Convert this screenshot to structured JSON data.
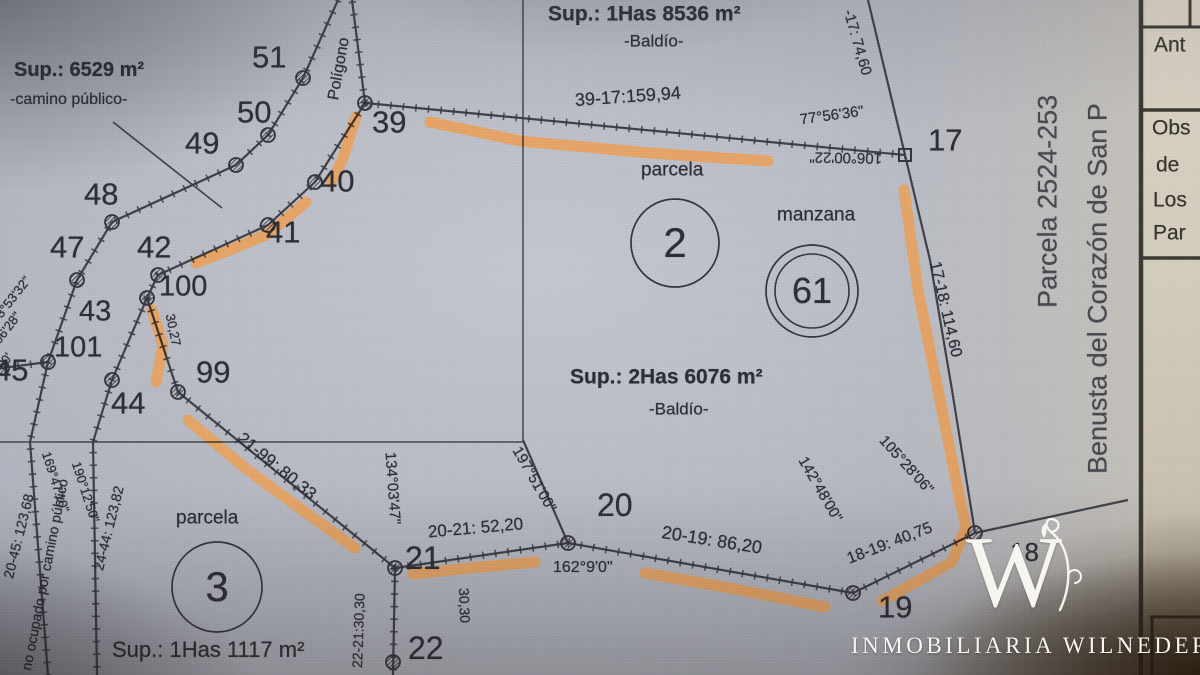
{
  "colors": {
    "highlight": "#f0a45c",
    "ink": "#32323c",
    "sheet_line": "#3a3a44",
    "panel_ink": "#2b2925",
    "panel_bg": "#d8d1c1",
    "brand_white": "#f7f5f0"
  },
  "panel": {
    "ant": "Ant",
    "obs": "Obs",
    "de": "de",
    "los": "Los",
    "par": "Par"
  },
  "watermark": {
    "monogram": "W",
    "brand": "INMOBILIARIA WILNEDER"
  },
  "map": {
    "labels": [
      {
        "t": "Sup.: 6529 m²",
        "x": 14,
        "y": 70,
        "s": 20,
        "b": 1,
        "n": "area-label-camino"
      },
      {
        "t": "-camino público-",
        "x": 10,
        "y": 100,
        "s": 16,
        "n": "area-sublabel-camino"
      },
      {
        "t": "51",
        "x": 252,
        "y": 57,
        "s": 31,
        "n": "vertex-label-51"
      },
      {
        "t": "50",
        "x": 237,
        "y": 112,
        "s": 31,
        "n": "vertex-label-50"
      },
      {
        "t": "49",
        "x": 185,
        "y": 143,
        "s": 31,
        "n": "vertex-label-49"
      },
      {
        "t": "48",
        "x": 84,
        "y": 194,
        "s": 31,
        "n": "vertex-label-48"
      },
      {
        "t": "47",
        "x": 50,
        "y": 247,
        "s": 31,
        "n": "vertex-label-47"
      },
      {
        "t": "42",
        "x": 137,
        "y": 247,
        "s": 31,
        "n": "vertex-label-42"
      },
      {
        "t": "100",
        "x": 159,
        "y": 287,
        "s": 29,
        "n": "vertex-label-100"
      },
      {
        "t": "43",
        "x": 79,
        "y": 312,
        "s": 29,
        "n": "vertex-label-43"
      },
      {
        "t": "101",
        "x": 54,
        "y": 348,
        "s": 29,
        "n": "vertex-label-101"
      },
      {
        "t": "45",
        "x": -6,
        "y": 370,
        "s": 31,
        "n": "vertex-label-45"
      },
      {
        "t": "44",
        "x": 111,
        "y": 403,
        "s": 31,
        "n": "vertex-label-44"
      },
      {
        "t": "99",
        "x": 196,
        "y": 372,
        "s": 31,
        "n": "vertex-label-99"
      },
      {
        "t": "39",
        "x": 372,
        "y": 122,
        "s": 31,
        "n": "vertex-label-39"
      },
      {
        "t": "40",
        "x": 320,
        "y": 181,
        "s": 31,
        "n": "vertex-label-40"
      },
      {
        "t": "41",
        "x": 266,
        "y": 232,
        "s": 31,
        "n": "vertex-label-41"
      },
      {
        "t": "Sup.: 1Has 8536 m²",
        "x": 548,
        "y": 14,
        "s": 21,
        "b": 1,
        "n": "area-label-top-parcel"
      },
      {
        "t": "-Baldío-",
        "x": 624,
        "y": 41,
        "s": 17
      },
      {
        "t": "39-17:159,94",
        "x": 575,
        "y": 100,
        "s": 18,
        "r": -4,
        "n": "distance-39-17"
      },
      {
        "t": "77°56'36\"",
        "x": 800,
        "y": 120,
        "s": 15,
        "r": -8
      },
      {
        "t": "106°00'22\"",
        "x": 882,
        "y": 158,
        "s": 15,
        "r": 181
      },
      {
        "t": "17",
        "x": 928,
        "y": 140,
        "s": 31,
        "n": "vertex-label-17"
      },
      {
        "t": "parcela",
        "x": 641,
        "y": 170,
        "s": 19,
        "n": "parcela-2-caption"
      },
      {
        "t": "manzana",
        "x": 777,
        "y": 215,
        "s": 19,
        "n": "manzana-caption"
      },
      {
        "t": "Sup.: 2Has 6076 m²",
        "x": 570,
        "y": 377,
        "s": 21,
        "b": 1,
        "n": "area-label-parcel2"
      },
      {
        "t": "-Baldío-",
        "x": 649,
        "y": 409,
        "s": 17
      },
      {
        "t": "20",
        "x": 597,
        "y": 505,
        "s": 32,
        "n": "vertex-label-20"
      },
      {
        "t": "162°9'0\"",
        "x": 553,
        "y": 568,
        "s": 16
      },
      {
        "t": "20-19: 86,20",
        "x": 662,
        "y": 532,
        "s": 18,
        "r": 9,
        "n": "distance-20-19"
      },
      {
        "t": "19",
        "x": 878,
        "y": 607,
        "s": 31,
        "n": "vertex-label-19"
      },
      {
        "t": "21",
        "x": 405,
        "y": 558,
        "s": 32,
        "n": "vertex-label-21"
      },
      {
        "t": "20-21: 52,20",
        "x": 428,
        "y": 532,
        "s": 17,
        "r": -5,
        "n": "distance-20-21"
      },
      {
        "t": "22",
        "x": 408,
        "y": 648,
        "s": 32,
        "n": "vertex-label-22"
      },
      {
        "t": "parcela",
        "x": 176,
        "y": 518,
        "s": 19,
        "n": "parcela-3-caption"
      },
      {
        "t": "Sup.: 1Has 1117 m²",
        "x": 112,
        "y": 650,
        "s": 22,
        "n": "area-label-parcel3"
      },
      {
        "t": "Polígono",
        "x": 334,
        "y": 100,
        "s": 16,
        "r": -80
      },
      {
        "t": "-17: 74,60",
        "x": 848,
        "y": 10,
        "s": 15,
        "r": 74
      },
      {
        "t": "17-18: 114,60",
        "x": 934,
        "y": 262,
        "s": 16,
        "r": 77,
        "n": "distance-17-18"
      },
      {
        "t": "105°28'06\"",
        "x": 882,
        "y": 438,
        "s": 15,
        "r": 48
      },
      {
        "t": "142°48'00\"",
        "x": 802,
        "y": 458,
        "s": 15,
        "r": 60
      },
      {
        "t": "18-19: 40,75",
        "x": 848,
        "y": 560,
        "s": 16,
        "r": -21,
        "n": "distance-18-19"
      },
      {
        "t": "197°51'00\"",
        "x": 516,
        "y": 448,
        "s": 15,
        "r": 60
      },
      {
        "t": "21-99: 80,33",
        "x": 240,
        "y": 436,
        "s": 17,
        "r": 39,
        "n": "distance-21-99"
      },
      {
        "t": "134°03'47\"",
        "x": 390,
        "y": 452,
        "s": 15,
        "r": 86
      },
      {
        "t": "22-21:30,30",
        "x": 357,
        "y": 668,
        "s": 14,
        "r": -88,
        "n": "distance-22-21"
      },
      {
        "t": "30,30",
        "x": 464,
        "y": 588,
        "s": 14,
        "r": 88
      },
      {
        "t": "30,27",
        "x": 170,
        "y": 314,
        "s": 13,
        "r": 78
      },
      {
        "t": "20-45: 123,68",
        "x": 8,
        "y": 578,
        "s": 14,
        "r": -76
      },
      {
        "t": "24-44: 123,82",
        "x": 98,
        "y": 570,
        "s": 14,
        "r": -76
      },
      {
        "t": "169°47'10\"",
        "x": 46,
        "y": 452,
        "s": 13,
        "r": 72
      },
      {
        "t": "190°12'50\"",
        "x": 76,
        "y": 462,
        "s": 13,
        "r": 72
      },
      {
        "t": "no ocupado por camino público",
        "x": 26,
        "y": 670,
        "s": 14,
        "r": -79,
        "n": "road-caption"
      },
      {
        "t": "3°53'32\"",
        "x": -2,
        "y": 316,
        "s": 13,
        "r": -52
      },
      {
        "t": "06'28\"",
        "x": -4,
        "y": 342,
        "s": 13,
        "r": -52
      },
      {
        "t": "°50'",
        "x": -4,
        "y": 372,
        "s": 13,
        "r": -52
      },
      {
        "t": "18",
        "x": 1010,
        "y": 552,
        "s": 26,
        "n": "vertex-label-18"
      },
      {
        "t": "Parcela 2524-253",
        "x": 1048,
        "y": 308,
        "s": 27,
        "r": -90,
        "c": "soft",
        "n": "side-text-parcela"
      },
      {
        "t": "Benusta del Corazón de San P",
        "x": 1098,
        "y": 474,
        "s": 27,
        "r": -90,
        "c": "soft",
        "n": "side-text-benusta"
      }
    ],
    "circles": [
      {
        "x": 675,
        "y": 243,
        "r": 44,
        "num": "2",
        "fs": 42,
        "n": "parcela-2-circle"
      },
      {
        "x": 812,
        "y": 291,
        "r": 46,
        "r2": 37,
        "num": "61",
        "fs": 36,
        "n": "manzana-61-circle"
      },
      {
        "x": 217,
        "y": 587,
        "r": 45,
        "num": "3",
        "fs": 42,
        "n": "parcela-3-circle"
      }
    ],
    "lines": [
      {
        "p": [
          [
            365,
            103
          ],
          [
            905,
            155
          ]
        ],
        "cls": "tick"
      },
      {
        "p": [
          [
            365,
            103
          ],
          [
            352,
            0
          ]
        ],
        "cls": "tick"
      },
      {
        "p": [
          [
            365,
            103
          ],
          [
            315,
            182
          ],
          [
            268,
            225
          ],
          [
            158,
            275
          ],
          [
            147,
            298
          ]
        ],
        "cls": "tick"
      },
      {
        "p": [
          [
            338,
            0
          ],
          [
            303,
            78
          ],
          [
            268,
            135
          ],
          [
            236,
            165
          ],
          [
            112,
            222
          ],
          [
            77,
            280
          ],
          [
            48,
            362
          ],
          [
            2,
            368
          ]
        ],
        "cls": "tick"
      },
      {
        "p": [
          [
            48,
            362
          ],
          [
            30,
            442
          ],
          [
            48,
            675
          ]
        ],
        "cls": "tick"
      },
      {
        "p": [
          [
            147,
            298
          ],
          [
            112,
            380
          ],
          [
            93,
            442
          ],
          [
            97,
            675
          ]
        ],
        "cls": "tick"
      },
      {
        "p": [
          [
            147,
            298
          ],
          [
            178,
            392
          ]
        ],
        "cls": "tick"
      },
      {
        "p": [
          [
            178,
            392
          ],
          [
            395,
            568
          ]
        ],
        "cls": "tick"
      },
      {
        "p": [
          [
            395,
            568
          ],
          [
            568,
            543
          ]
        ],
        "cls": "tick"
      },
      {
        "p": [
          [
            568,
            543
          ],
          [
            853,
            593
          ]
        ],
        "cls": "tick"
      },
      {
        "p": [
          [
            853,
            593
          ],
          [
            975,
            533
          ]
        ],
        "cls": "tick"
      },
      {
        "p": [
          [
            905,
            155
          ],
          [
            930,
            260
          ],
          [
            952,
            390
          ],
          [
            975,
            533
          ]
        ],
        "cls": ""
      },
      {
        "p": [
          [
            905,
            155
          ],
          [
            868,
            0
          ]
        ],
        "cls": ""
      },
      {
        "p": [
          [
            568,
            543
          ],
          [
            523,
            440
          ]
        ],
        "cls": ""
      },
      {
        "p": [
          [
            395,
            568
          ],
          [
            393,
            675
          ]
        ],
        "cls": "tick"
      },
      {
        "p": [
          [
            975,
            533
          ],
          [
            1128,
            500
          ]
        ],
        "cls": ""
      },
      {
        "p": [
          [
            113,
            122
          ],
          [
            222,
            208
          ]
        ],
        "w": 1.6,
        "cls": ""
      },
      {
        "p": [
          [
            523,
            0
          ],
          [
            523,
            441
          ]
        ],
        "w": 1.5,
        "cls": "thin"
      },
      {
        "p": [
          [
            0,
            442
          ],
          [
            523,
            442
          ]
        ],
        "w": 1.5,
        "cls": "thin"
      },
      {
        "p": [
          [
            1141,
            0
          ],
          [
            1141,
            675
          ]
        ],
        "w": 4.5,
        "cls": "panel"
      },
      {
        "p": [
          [
            1143,
            27
          ],
          [
            1200,
            27
          ]
        ],
        "w": 3,
        "cls": "panel"
      },
      {
        "p": [
          [
            1143,
            110
          ],
          [
            1200,
            110
          ]
        ],
        "w": 3.5,
        "cls": "panel"
      },
      {
        "p": [
          [
            1143,
            258
          ],
          [
            1200,
            258
          ]
        ],
        "w": 3.5,
        "cls": "panel"
      },
      {
        "p": [
          [
            1150,
            617
          ],
          [
            1200,
            617
          ]
        ],
        "w": 3,
        "cls": "panel"
      },
      {
        "p": [
          [
            1190,
            0
          ],
          [
            1190,
            27
          ]
        ],
        "w": 3,
        "cls": "panel"
      },
      {
        "p": [
          [
            1152,
            617
          ],
          [
            1152,
            675
          ]
        ],
        "w": 3,
        "cls": "panel"
      }
    ],
    "vertices": [
      [
        303,
        78
      ],
      [
        268,
        135
      ],
      [
        236,
        165
      ],
      [
        112,
        222
      ],
      [
        77,
        280
      ],
      [
        48,
        362
      ],
      [
        2,
        368
      ],
      [
        365,
        103
      ],
      [
        315,
        182
      ],
      [
        268,
        225
      ],
      [
        158,
        275
      ],
      [
        147,
        298
      ],
      [
        112,
        380
      ],
      [
        178,
        392
      ],
      [
        395,
        568
      ],
      [
        393,
        662
      ],
      [
        568,
        543
      ],
      [
        853,
        593
      ],
      [
        975,
        533
      ]
    ],
    "square_vertices": [
      [
        905,
        155
      ]
    ],
    "highlights": [
      {
        "p": [
          [
            430,
            122
          ],
          [
            520,
            141
          ],
          [
            650,
            153
          ],
          [
            768,
            161
          ]
        ]
      },
      {
        "p": [
          [
            356,
            117
          ],
          [
            343,
            158
          ],
          [
            331,
            183
          ]
        ]
      },
      {
        "p": [
          [
            306,
            202
          ],
          [
            268,
            234
          ],
          [
            225,
            252
          ],
          [
            196,
            263
          ]
        ]
      },
      {
        "p": [
          [
            152,
            310
          ],
          [
            163,
            345
          ],
          [
            156,
            382
          ]
        ]
      },
      {
        "p": [
          [
            188,
            420
          ],
          [
            245,
            468
          ],
          [
            305,
            512
          ],
          [
            355,
            548
          ]
        ]
      },
      {
        "p": [
          [
            413,
            574
          ],
          [
            470,
            568
          ],
          [
            535,
            562
          ]
        ]
      },
      {
        "p": [
          [
            645,
            573
          ],
          [
            730,
            588
          ],
          [
            825,
            607
          ]
        ]
      },
      {
        "p": [
          [
            904,
            190
          ],
          [
            918,
            290
          ],
          [
            944,
            420
          ],
          [
            960,
            500
          ],
          [
            966,
            527
          ],
          [
            952,
            562
          ],
          [
            918,
            581
          ],
          [
            882,
            601
          ]
        ]
      }
    ]
  }
}
